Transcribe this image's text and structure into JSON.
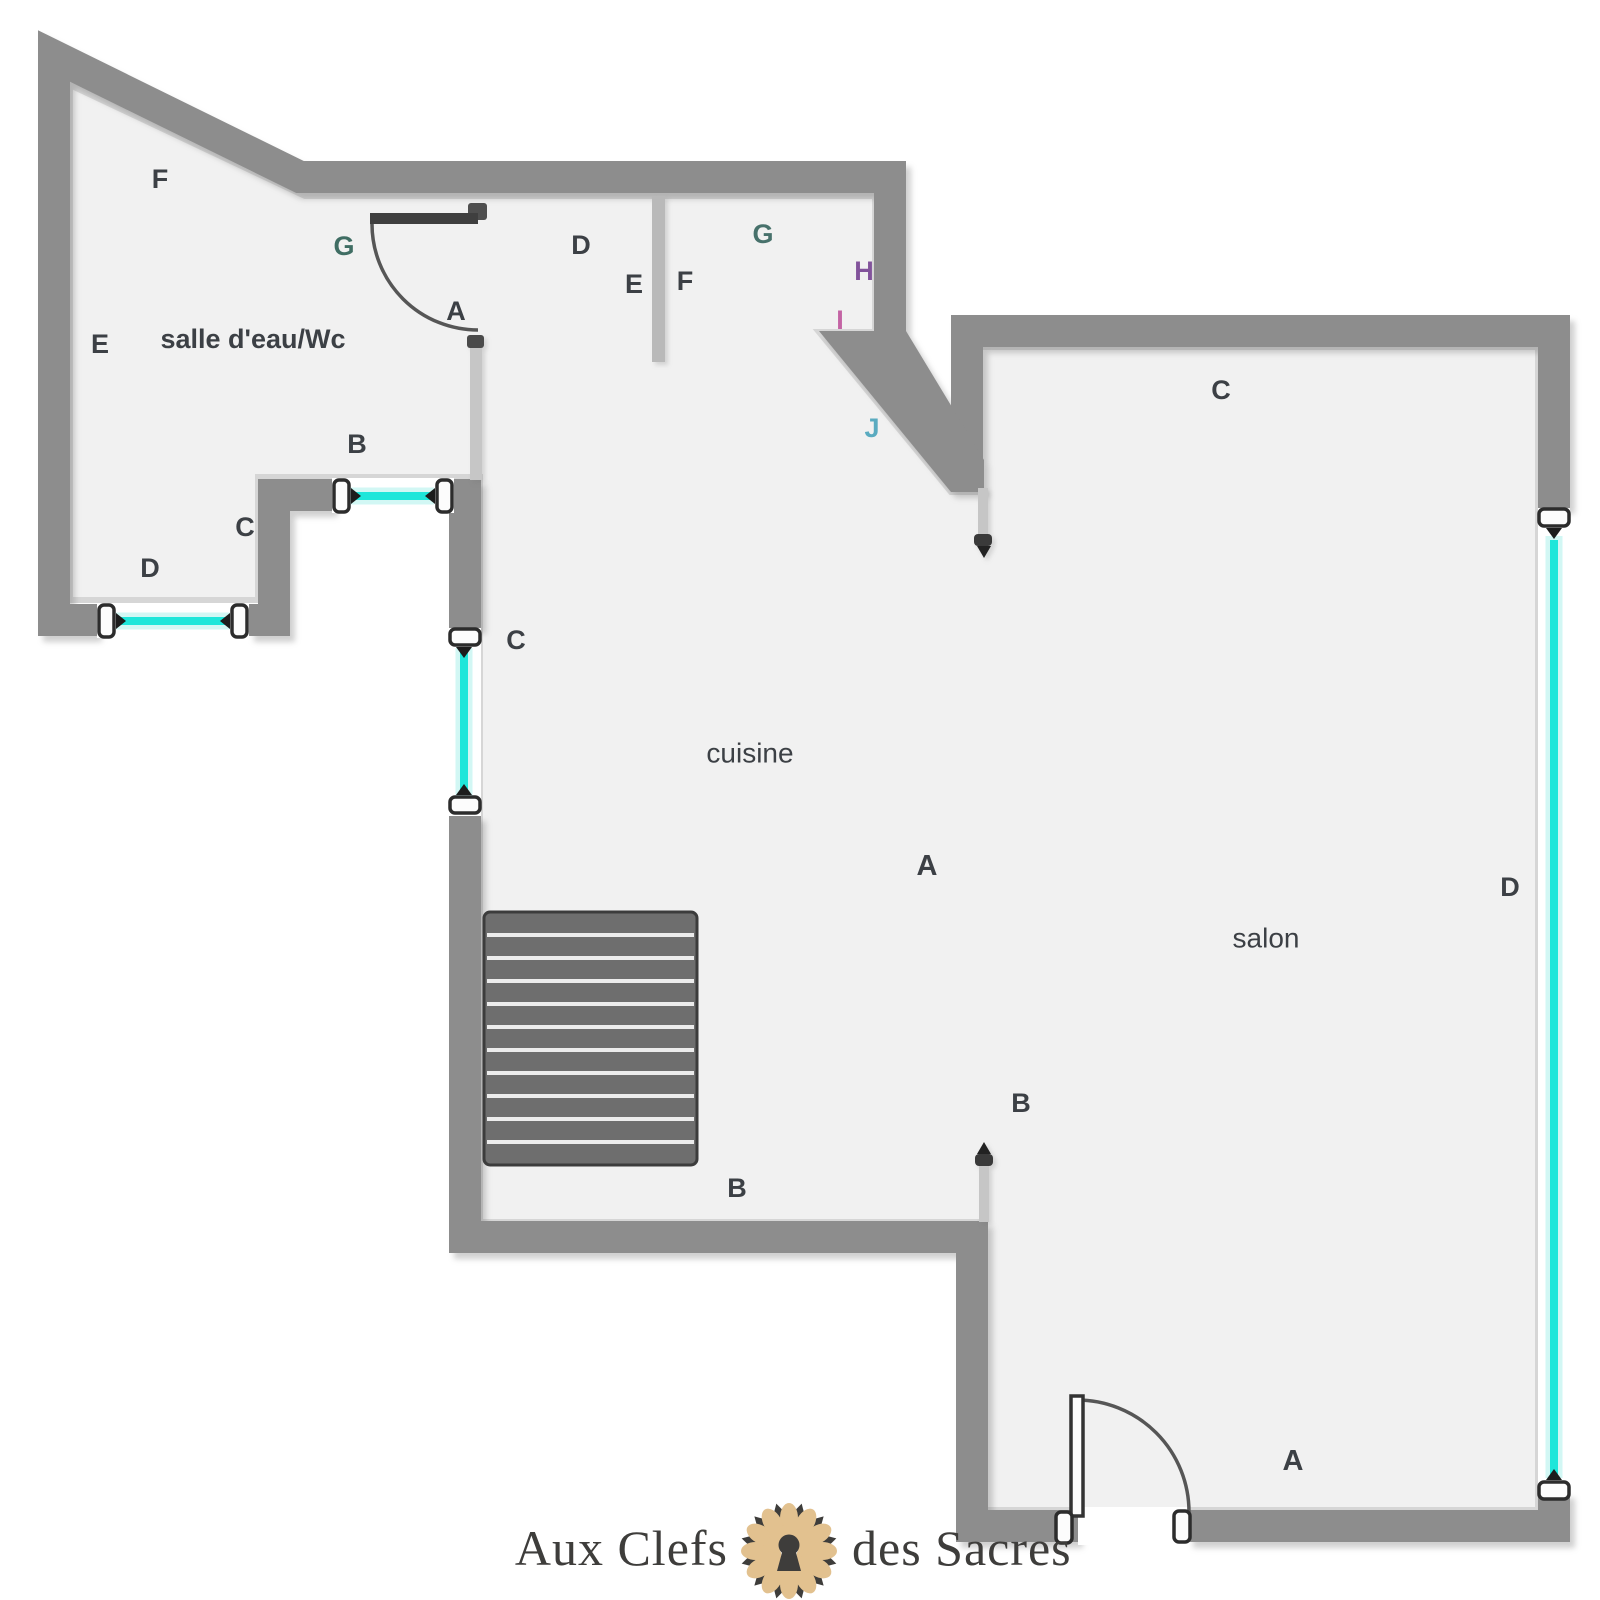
{
  "meta": {
    "type": "apartment floor plan",
    "width": 1600,
    "height": 1600
  },
  "colors": {
    "background": "#ffffff",
    "floor": "#f1f1f1",
    "floor_edge_highlight": "#d6d6d6",
    "wall": "#8d8d8d",
    "partition_wall": "#b9b9b9",
    "thin_wall": "#c6c6c6",
    "stair_fill": "#6e6e6e",
    "stair_tread": "#ececec",
    "window_glass": "#1ee6da",
    "window_halo": "#d2f7f4",
    "bracket_fill": "#fcfcfc",
    "bracket_stroke": "#2c2c2c",
    "door_stroke": "#565656",
    "label_default": "#3c4045",
    "watermark_text": "#3e3d3b",
    "logo_petal": "#e2c18f",
    "logo_dark": "#3e3d3b"
  },
  "rooms": [
    {
      "id": "salle-deau",
      "name": "salle d'eau/Wc",
      "x": 253,
      "y": 339,
      "size": 27,
      "weight": 700
    },
    {
      "id": "cuisine",
      "name": "cuisine",
      "x": 750,
      "y": 753,
      "size": 28,
      "weight": 500
    },
    {
      "id": "salon",
      "name": "salon",
      "x": 1266,
      "y": 938,
      "size": 28,
      "weight": 500
    }
  ],
  "markers": [
    {
      "text": "F",
      "x": 160,
      "y": 179
    },
    {
      "text": "E",
      "x": 100,
      "y": 344
    },
    {
      "text": "G",
      "x": 344,
      "y": 246,
      "color": "#3f6d63"
    },
    {
      "text": "A",
      "x": 456,
      "y": 311
    },
    {
      "text": "B",
      "x": 357,
      "y": 444
    },
    {
      "text": "C",
      "x": 245,
      "y": 527
    },
    {
      "text": "D",
      "x": 150,
      "y": 568
    },
    {
      "text": "D",
      "x": 581,
      "y": 245
    },
    {
      "text": "E",
      "x": 634,
      "y": 284
    },
    {
      "text": "F",
      "x": 685,
      "y": 281
    },
    {
      "text": "G",
      "x": 763,
      "y": 234,
      "color": "#47716b"
    },
    {
      "text": "H",
      "x": 864,
      "y": 271,
      "color": "#82539b"
    },
    {
      "text": "I",
      "x": 840,
      "y": 320,
      "color": "#c364a4"
    },
    {
      "text": "J",
      "x": 872,
      "y": 428,
      "color": "#5aabc0"
    },
    {
      "text": "C",
      "x": 516,
      "y": 640
    },
    {
      "text": "A",
      "x": 927,
      "y": 866,
      "size": 29
    },
    {
      "text": "B",
      "x": 737,
      "y": 1188
    },
    {
      "text": "B",
      "x": 1021,
      "y": 1103
    },
    {
      "text": "C",
      "x": 1221,
      "y": 390
    },
    {
      "text": "D",
      "x": 1510,
      "y": 887
    },
    {
      "text": "A",
      "x": 1293,
      "y": 1461,
      "size": 29
    }
  ],
  "watermark": {
    "text_left": "Aux Clefs",
    "text_right": "des Sacres"
  }
}
